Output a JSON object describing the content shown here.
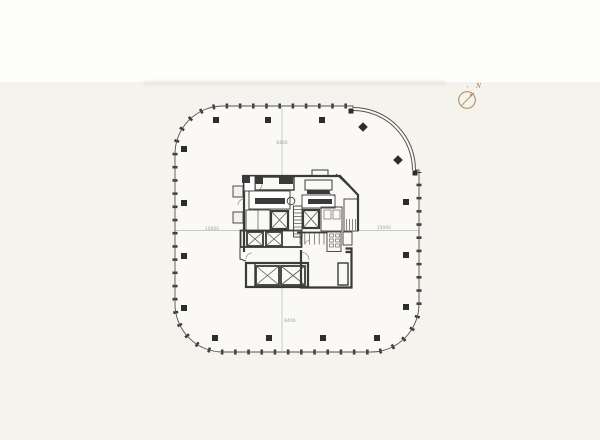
{
  "colors": {
    "paper": "#f5f3ee",
    "paper_top": "#fdfdfc",
    "paper_edge": "#e7e4de",
    "plan_fill": "#faf9f5",
    "wall": "#2d2d2d",
    "core_wall": "#3a3a3a",
    "outline": "#55534e",
    "centerline": "#a9bcc5",
    "dim_text": "#8fa3ad",
    "compass": "#b28f5e",
    "fixture": "#5a5751"
  },
  "dimension_labels": {
    "top": "8400",
    "bottom": "8400",
    "left": "15000",
    "right": "15000"
  },
  "compass": {
    "label": "N",
    "icon": "north-compass-icon"
  }
}
